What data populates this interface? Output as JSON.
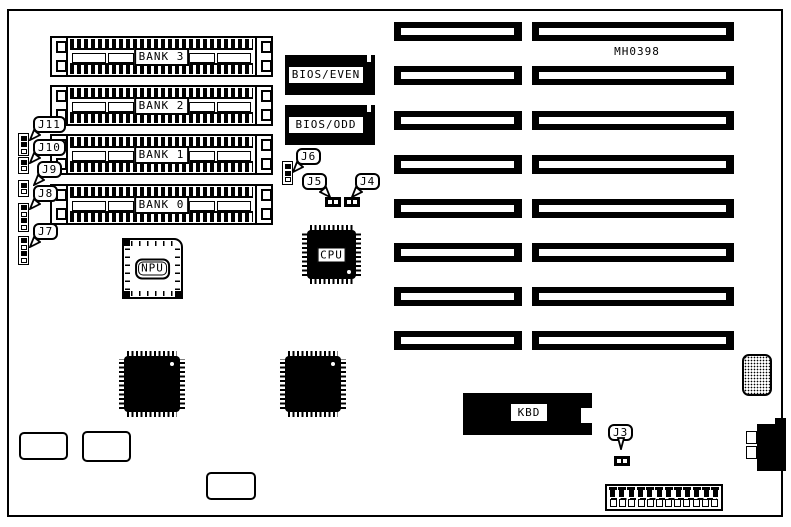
{
  "board": {
    "part_number": "MH0398"
  },
  "memory_banks": [
    {
      "label": "BANK 3"
    },
    {
      "label": "BANK 2"
    },
    {
      "label": "BANK 1"
    },
    {
      "label": "BANK 0"
    }
  ],
  "chips": {
    "bios_even": "BIOS/EVEN",
    "bios_odd": "BIOS/ODD",
    "npu": "NPU",
    "cpu": "CPU",
    "kbd": "KBD"
  },
  "jumpers": {
    "j3": "J3",
    "j4": "J4",
    "j5": "J5",
    "j6": "J6",
    "j7": "J7",
    "j8": "J8",
    "j9": "J9",
    "j10": "J10",
    "j11": "J11"
  }
}
